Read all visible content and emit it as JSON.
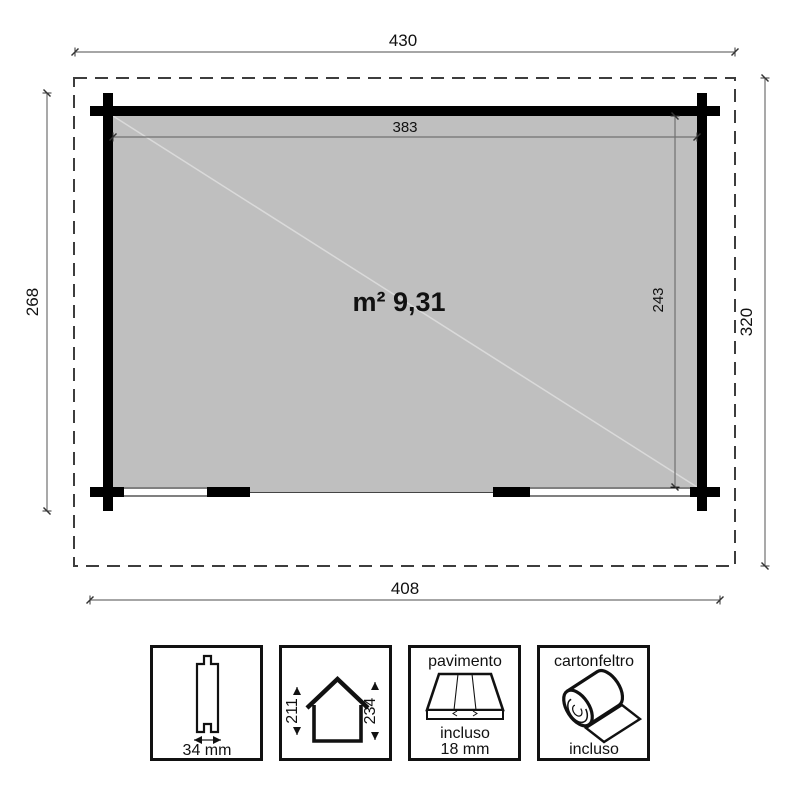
{
  "diagram": {
    "area_label": "m² 9,31",
    "dims": {
      "total_width": "430",
      "total_depth": "320",
      "base_width": "408",
      "base_depth": "268",
      "inner_width": "383",
      "inner_depth": "243"
    },
    "colors": {
      "floor_fill": "#bfbfbf",
      "wall": "#000000",
      "boundary": "#3d3d3d"
    }
  },
  "legend": {
    "wall_profile": {
      "thickness_label": "34 mm"
    },
    "house_heights": {
      "wall_height": "211",
      "ridge_height": "234"
    },
    "floor": {
      "title": "pavimento",
      "included_label": "incluso",
      "thickness_label": "18 mm"
    },
    "roof_felt": {
      "title": "cartonfeltro",
      "included_label": "incluso"
    }
  }
}
